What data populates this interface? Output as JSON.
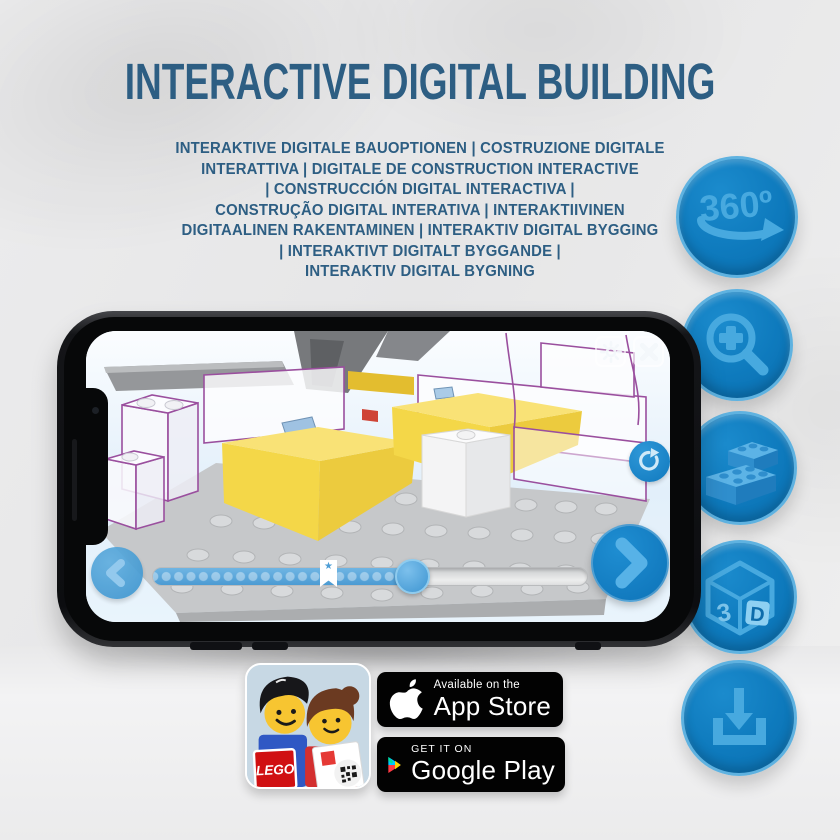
{
  "title": "INTERACTIVE DIGITAL BUILDING",
  "subtitle_lines": [
    "INTERAKTIVE DIGITALE BAUOPTIONEN | COSTRUZIONE DIGITALE",
    "INTERATTIVA | DIGITALE DE CONSTRUCTION INTERACTIVE",
    "| CONSTRUCCIÓN DIGITAL INTERACTIVA |",
    "CONSTRUÇÃO DIGITAL INTERATIVA | INTERAKTIIVINEN",
    "DIGITAALINEN RAKENTAMINEN | INTERAKTIV DIGITAL BYGGING",
    "| INTERAKTIVT DIGITALT BYGGANDE |",
    "INTERAKTIV DIGITAL BYGNING"
  ],
  "feature_badges": {
    "icons": [
      "360-rotation-icon",
      "zoom-in-icon",
      "lego-brick-icon",
      "3d-cube-icon",
      "download-icon"
    ],
    "rotation_label": "360º",
    "cube_left_label": "3",
    "cube_right_label": "D"
  },
  "phone_app": {
    "ui_icons": [
      "gear-icon",
      "close-icon",
      "rotate-reset-icon",
      "back-chevron-icon",
      "next-chevron-icon",
      "bookmark-star-icon"
    ],
    "bookmark_star": "★"
  },
  "store": {
    "app_icon_logo": "LEGO",
    "app_store": {
      "tagline": "Available on the",
      "name": "App Store"
    },
    "google_play": {
      "tagline": "GET IT ON",
      "name": "Google Play"
    }
  },
  "colors": {
    "heading_blue": "#2d5e83",
    "badge_blue": "#0e7abd",
    "badge_icon_blue": "#47a9df",
    "brick_yellow": "#f4d748",
    "outline_purple": "#9a4f9e",
    "screen_sky": "#e6f2fb"
  }
}
